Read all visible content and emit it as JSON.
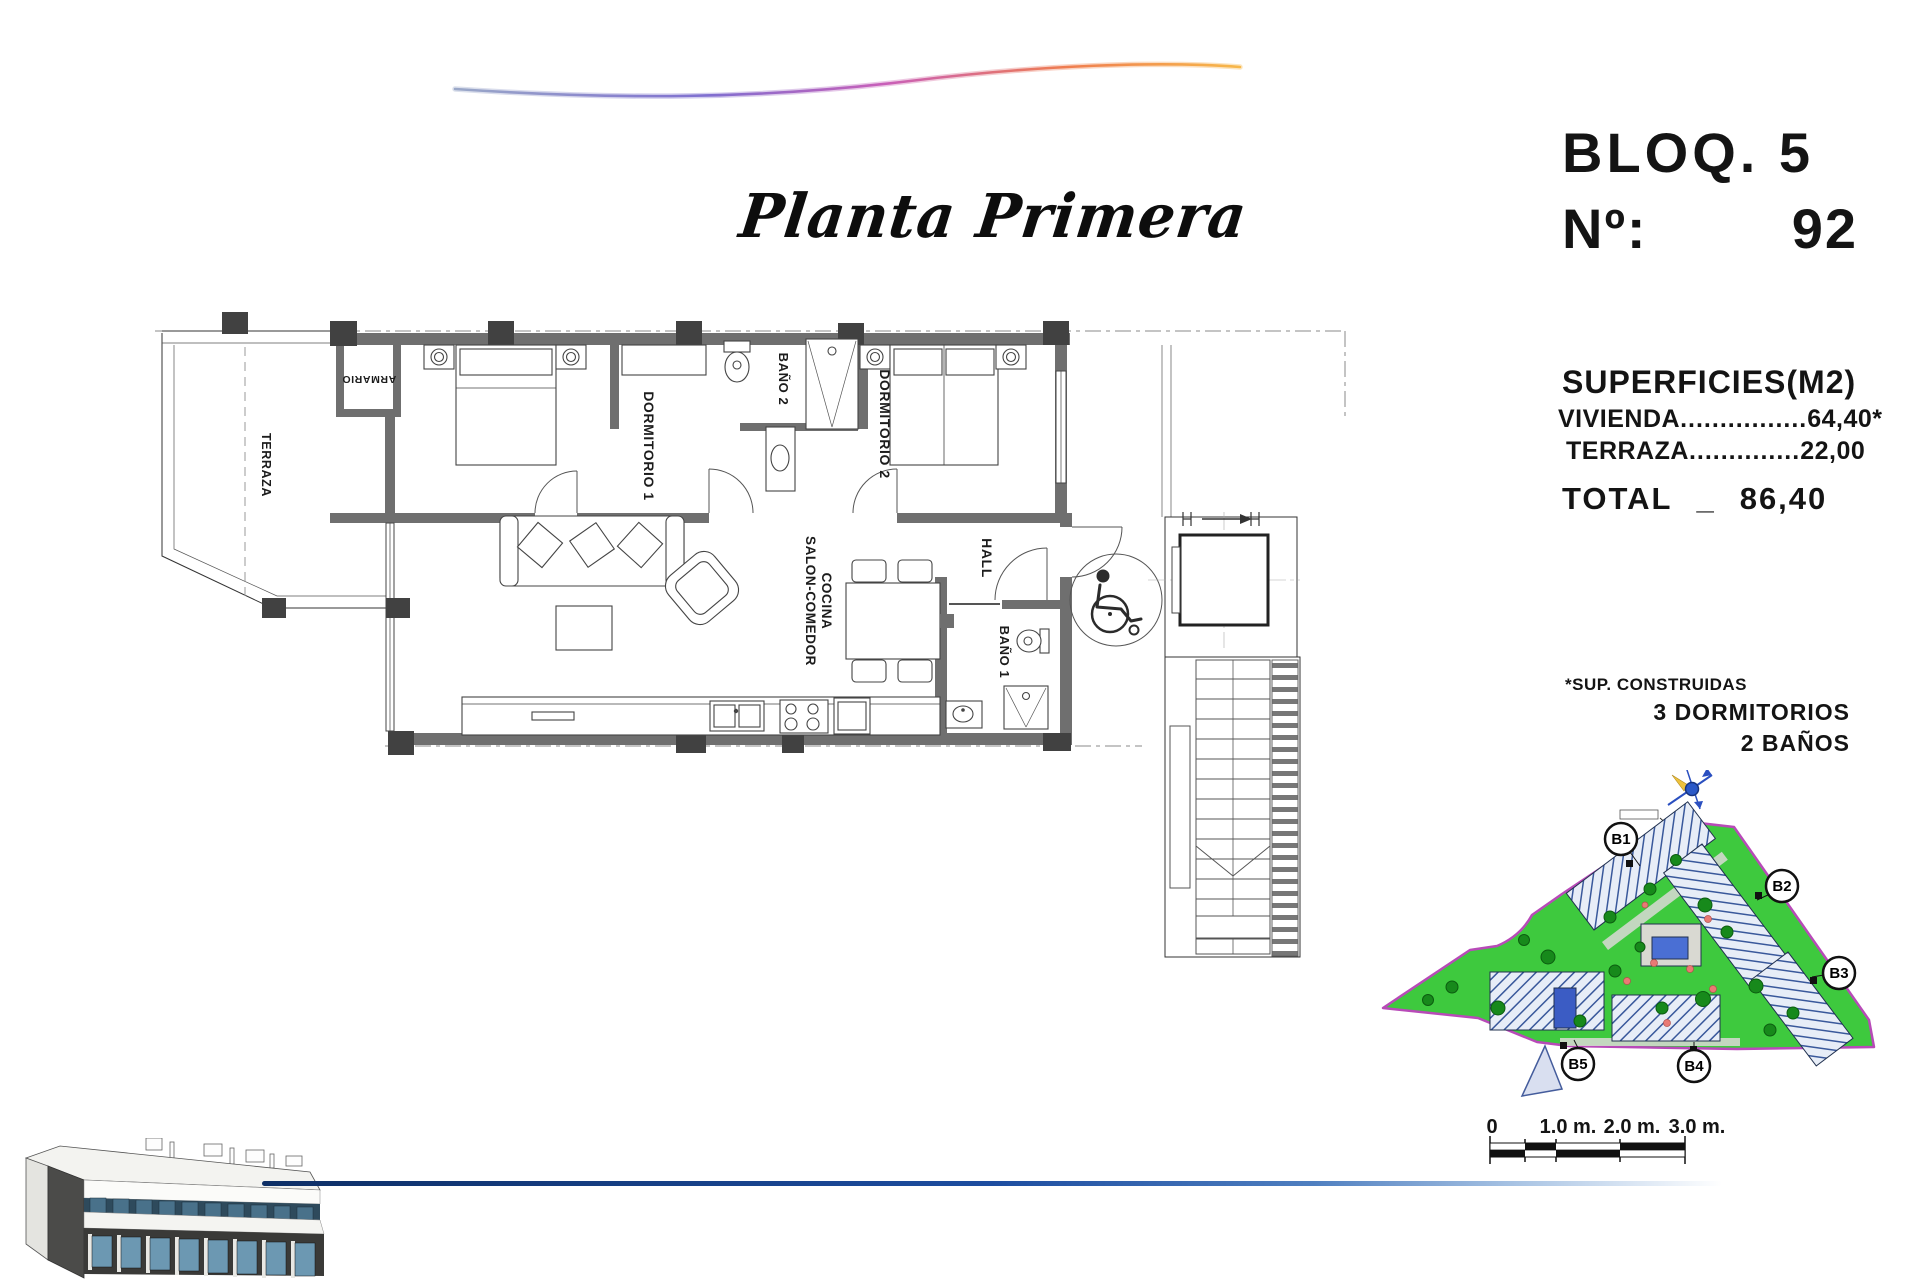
{
  "header": {
    "block_label": "BLOQ. 5",
    "unit_label": "Nº:",
    "unit_number": "92"
  },
  "plan_title": "Planta Primera",
  "surfaces": {
    "heading": "SUPERFICIES(M2)",
    "rows": [
      {
        "label": "VIVIENDA",
        "leader": "................",
        "value": "64,40*"
      },
      {
        "label": "TERRAZA",
        "leader": "..............",
        "value": "22,00"
      }
    ],
    "total_label": "TOTAL",
    "total_separator": "_",
    "total_value": "86,40"
  },
  "notes": {
    "surface_note": "*SUP. CONSTRUIDAS",
    "bedrooms": "3 DORMITORIOS",
    "bathrooms": "2 BAÑOS"
  },
  "floor_plan": {
    "rooms": {
      "terraza": "TERRAZA",
      "armario": "ARMARIO",
      "dormitorio1": "DORMITORIO 1",
      "bano2": "BAÑO 2",
      "dormitorio2": "DORMITORIO 2",
      "hall": "HALL",
      "salon_line1": "SALON-COMEDOR",
      "salon_line2": "COCINA",
      "bano1": "BAÑO 1"
    }
  },
  "site_plan": {
    "blocks": [
      "B1",
      "B2",
      "B3",
      "B4",
      "B5"
    ],
    "colors": {
      "grass": "#3ec93e",
      "boundary": "#b84ab8",
      "pool": "#3b5cc4",
      "building_fill": "#e7edf7",
      "building_hatch": "#39589b"
    }
  },
  "scale_bar": {
    "labels": [
      "0",
      "1.0 m.",
      "2.0 m.",
      "3.0 m."
    ]
  },
  "accents": {
    "swoosh_gradient": [
      "#9aa8c8",
      "#7f6fd0",
      "#c95fb8",
      "#ef7d4f",
      "#f7b84a"
    ],
    "bottom_line_color": "#0e2f66"
  }
}
